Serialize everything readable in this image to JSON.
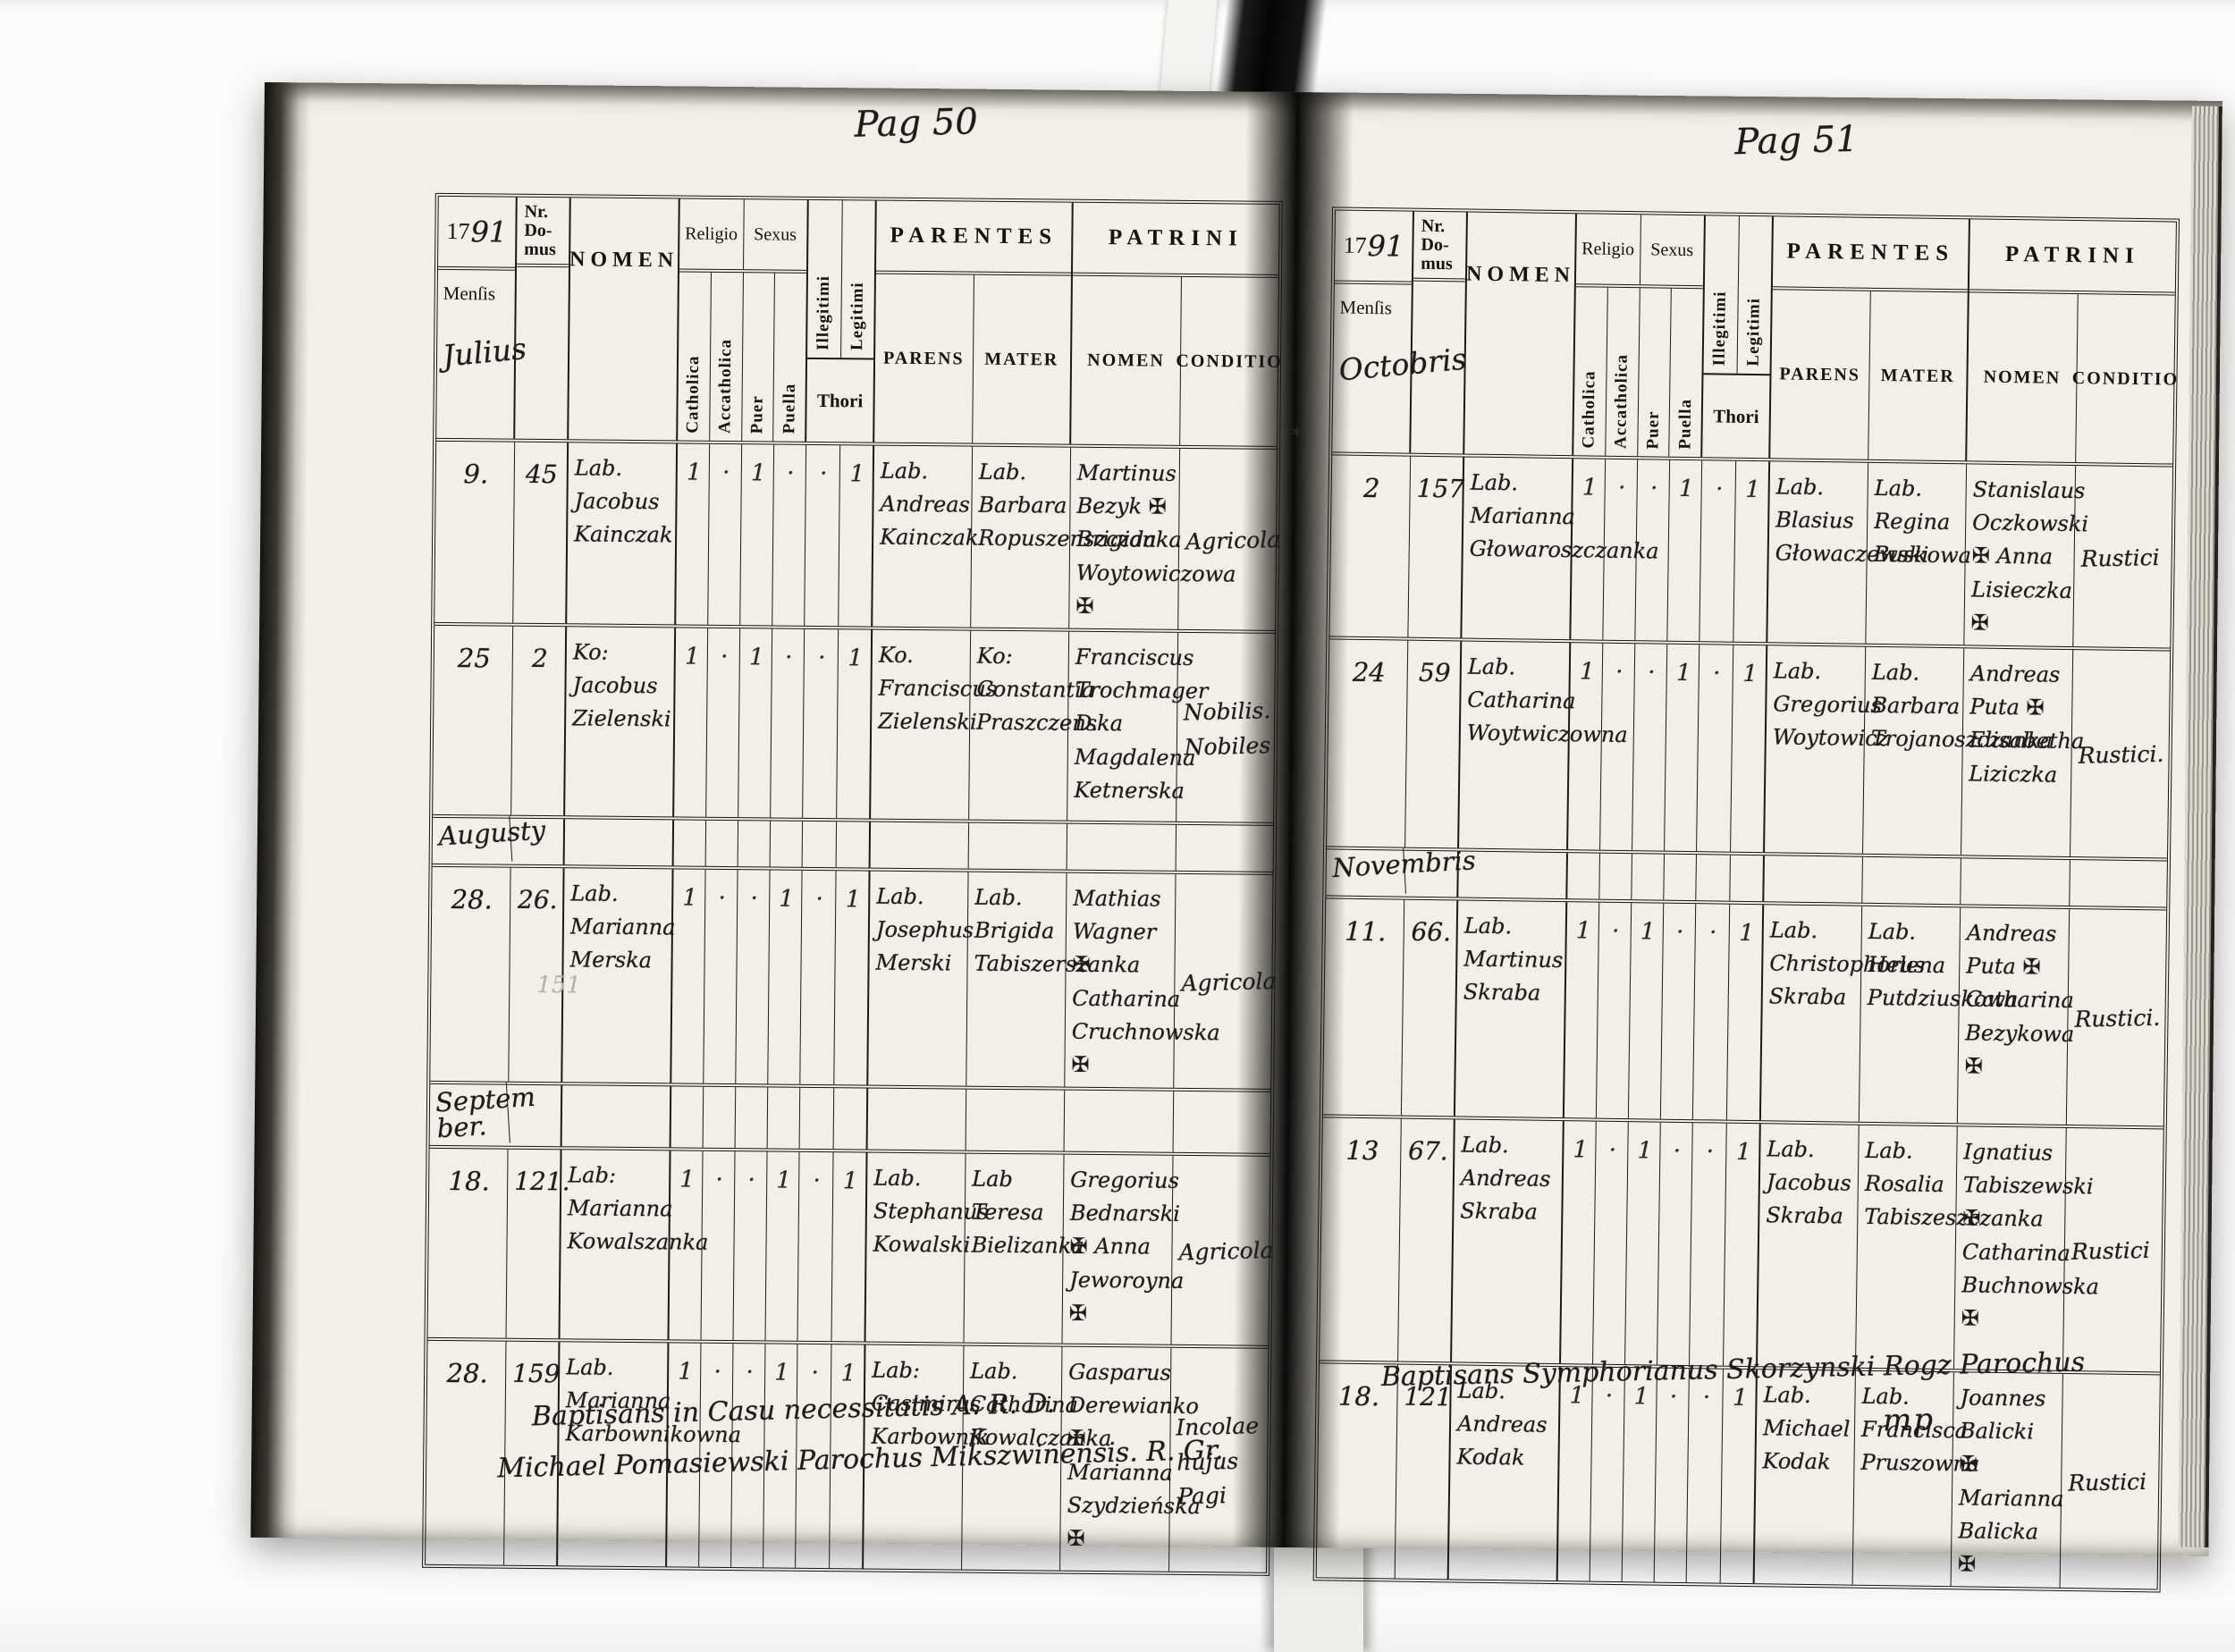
{
  "header_labels": {
    "nr_domus": "Nr.\nDo-\nmus",
    "nomen": "NOMEN",
    "religio": "Religio",
    "sexus": "Sexus",
    "catholica": "Catholica",
    "acatholica": "Accatholica",
    "puer": "Puer",
    "puella": "Puella",
    "illegitimi": "Illegitimi",
    "legitimi": "Legitimi",
    "thori": "Thori",
    "parentes": "PARENTES",
    "patrini": "PATRINI",
    "parens": "PARENS",
    "mater": "MATER",
    "patrini_nomen": "NOMEN",
    "conditio": "CONDITIO",
    "mensis": "Menſis",
    "year_printed": "17",
    "year_script": "91"
  },
  "pages": [
    {
      "page_label": "Pag 50",
      "month": "Julius",
      "pencil_note": "151",
      "margin_mark": "",
      "footer": [
        "Baptisans in Casu necessitatis A. R. D.",
        "Michael Pomasiewski Parochus Mikszwinensis. R. Gr."
      ],
      "rows": [
        {
          "date": "9.",
          "nr": "45",
          "nomen": "Lab. Jacobus Kainczak",
          "catholica": "1",
          "acatholica": "·",
          "puer": "1",
          "puella": "·",
          "illegitimi": "·",
          "legitimi": "1",
          "parens": "Lab. Andreas Kainczak",
          "mater": "Lab. Barbara Ropuszenszczanka",
          "patrini_nomen": "Martinus Bezyk ✠ Brigida Woytowiczowa ✠",
          "conditio": "Agricola"
        },
        {
          "date": "25",
          "nr": "2",
          "nomen": "Ko: Jacobus Zielenski",
          "catholica": "1",
          "acatholica": "·",
          "puer": "1",
          "puella": "·",
          "illegitimi": "·",
          "legitimi": "1",
          "parens": "Ko. Franciscus Zielenski",
          "mater": "Ko: Constantia Praszczenska",
          "patrini_nomen": "Franciscus Trochmager D. Magdalena Ketnerska",
          "conditio": "Nobilis. Nobiles"
        },
        {
          "section": "Augusty"
        },
        {
          "date": "28.",
          "nr": "26.",
          "nomen": "Lab. Marianna Merska",
          "catholica": "1",
          "acatholica": "·",
          "puer": "·",
          "puella": "1",
          "illegitimi": "·",
          "legitimi": "1",
          "parens": "Lab. Josephus Merski",
          "mater": "Lab. Brigida Tabiszerszanka",
          "patrini_nomen": "Mathias Wagner ✠ Catharina Cruchnowska ✠",
          "conditio": "Agricola"
        },
        {
          "section": "Septem\nber."
        },
        {
          "date": "18.",
          "nr": "121.",
          "nomen": "Lab: Marianna Kowalszanka",
          "catholica": "1",
          "acatholica": "·",
          "puer": "·",
          "puella": "1",
          "illegitimi": "·",
          "legitimi": "1",
          "parens": "Lab. Stephanus Kowalski",
          "mater": "Lab Teresa Bielizanka",
          "patrini_nomen": "Gregorius Bednarski ✠ Anna Jeworoyna ✠",
          "conditio": "Agricola"
        },
        {
          "date": "28.",
          "nr": "159",
          "nomen": "Lab. Marianna Karbownikowna",
          "catholica": "1",
          "acatholica": "·",
          "puer": "·",
          "puella": "1",
          "illegitimi": "·",
          "legitimi": "1",
          "parens": "Lab: Casimirus Karbownik",
          "mater": "Lab. Catharina Kowalczanka",
          "patrini_nomen": "Gasparus Derewianko ✠ Marianna Szydzieńska ✠",
          "conditio": "Incolae hujus Pagi"
        }
      ],
      "row_heights": "200,215,55,225,55,215,250"
    },
    {
      "page_label": "Pag 51",
      "month": "Octobris",
      "pencil_note": "",
      "margin_mark": "*",
      "footer": [
        "Baptisans Symphorianus Skorzynski Rogz Parochus",
        "mp"
      ],
      "rows": [
        {
          "date": "2",
          "nr": "157",
          "nomen": "Lab. Marianna Głowaroszczanka",
          "catholica": "1",
          "acatholica": "·",
          "puer": "·",
          "puella": "1",
          "illegitimi": "·",
          "legitimi": "1",
          "parens": "Lab. Blasius Głowaczewski",
          "mater": "Lab. Regina Buskowa",
          "patrini_nomen": "Stanislaus Oczkowski ✠ Anna Lisieczka ✠",
          "conditio": "Rustici"
        },
        {
          "date": "24",
          "nr": "59",
          "nomen": "Lab. Catharina Woytwiczowna",
          "catholica": "1",
          "acatholica": "·",
          "puer": "·",
          "puella": "1",
          "illegitimi": "·",
          "legitimi": "1",
          "parens": "Lab. Gregorius Woytowicz",
          "mater": "Lab. Barbara Trojanoszczanka",
          "patrini_nomen": "Andreas Puta ✠ Elisabetha Liziczka",
          "conditio": "Rustici."
        },
        {
          "section": "Novembris"
        },
        {
          "date": "11.",
          "nr": "66.",
          "nomen": "Lab. Martinus Skraba",
          "catholica": "1",
          "acatholica": "·",
          "puer": "1",
          "puella": "·",
          "illegitimi": "·",
          "legitimi": "1",
          "parens": "Lab. Christophorus Skraba",
          "mater": "Lab. Helena Putdziuskowa",
          "patrini_nomen": "Andreas Puta ✠ Catharina Bezykowa ✠",
          "conditio": "Rustici."
        },
        {
          "date": "13",
          "nr": "67.",
          "nomen": "Lab. Andreas Skraba",
          "catholica": "1",
          "acatholica": "·",
          "puer": "1",
          "puella": "·",
          "illegitimi": "·",
          "legitimi": "1",
          "parens": "Lab. Jacobus Skraba",
          "mater": "Lab. Rosalia Tabiszeszczanka",
          "patrini_nomen": "Ignatius Tabiszewski ✠ Catharina Buchnowska ✠",
          "conditio": "Rustici"
        },
        {
          "date": "18.",
          "nr": "121",
          "nomen": "Lab. Andreas Kodak",
          "catholica": "1",
          "acatholica": "·",
          "puer": "1",
          "puella": "·",
          "illegitimi": "·",
          "legitimi": "1",
          "parens": "Lab. Michael Kodak",
          "mater": "Lab. Francisca Pruszowna",
          "patrini_nomen": "Joannes Balicki ✠ Marianna Balicka ✠",
          "conditio": "Rustici"
        }
      ],
      "row_heights": "190,235,55,245,275,205"
    }
  ]
}
